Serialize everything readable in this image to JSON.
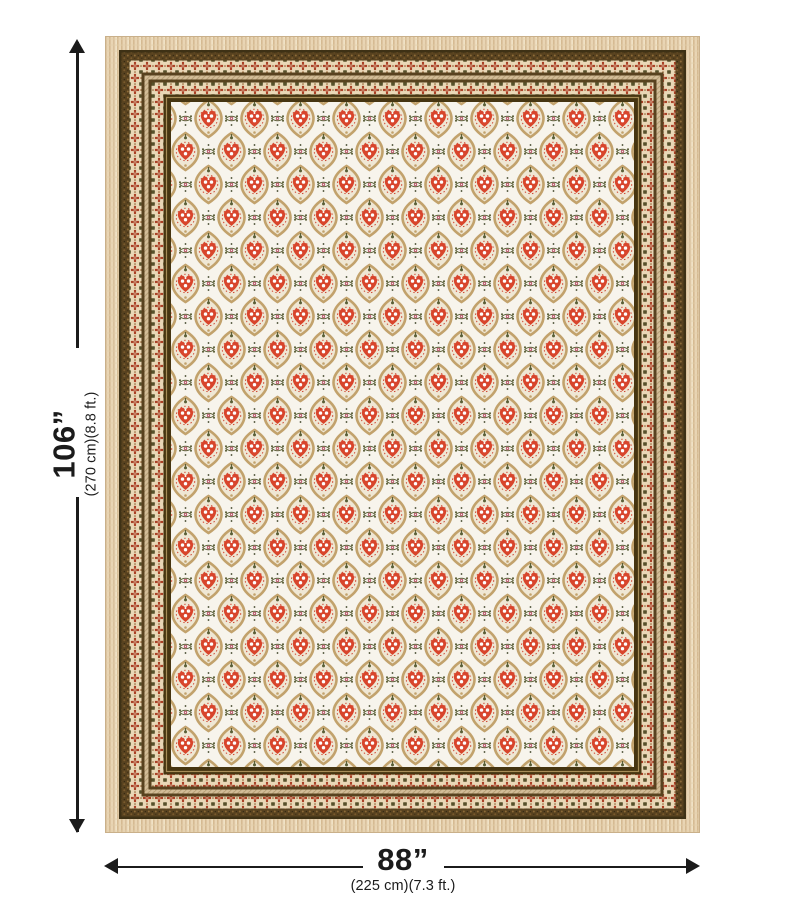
{
  "figure": {
    "type": "product-dimension-image",
    "background": "#ffffff",
    "description": "red and cream block-print bedsheet with layered decorative borders, shown with height and width measurement arrows"
  },
  "product": {
    "palette": {
      "fringe_cream": "#e9d5b4",
      "fringe_stripe": "#d5ba92",
      "edge_dark": "#3e3115",
      "border_brown": "#58421f",
      "border_dark_inner": "#463511",
      "band_cream": "#e9d7b6",
      "band_flower_red": "#a83c22",
      "tan_stripe": "#d3bd98",
      "gold_pinline": "#a68d58",
      "field_white": "#f7f4ec",
      "motif_red": "#d8452c",
      "motif_tan": "#c2a26c",
      "motif_olive": "#5a5f37",
      "motif_pink": "#b8556a"
    }
  },
  "dimensions": {
    "arrow_color": "#1b1b1b",
    "height": {
      "primary": "106”",
      "secondary": "(270 cm)(8.8 ft.)"
    },
    "width": {
      "primary": "88”",
      "secondary": "(225 cm)(7.3 ft.)"
    }
  }
}
